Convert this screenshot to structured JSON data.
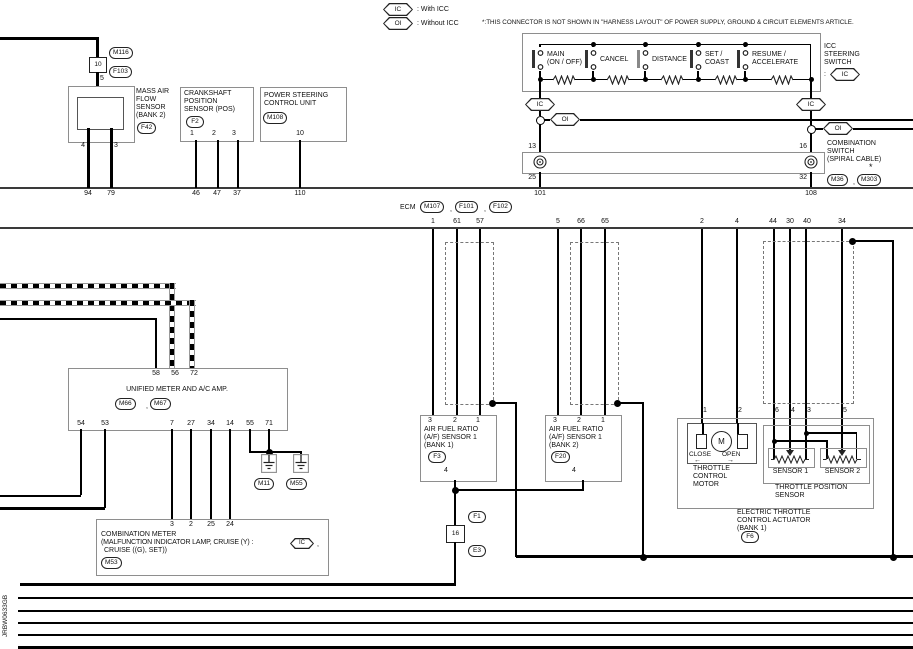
{
  "legend": {
    "ic": "IC",
    "ic_desc": ": With ICC",
    "oi": "OI",
    "oi_desc": ": Without ICC",
    "note": "*:THIS CONNECTOR IS NOT SHOWN IN \"HARNESS LAYOUT\" OF POWER SUPPLY, GROUND & CIRCUIT ELEMENTS ARTICLE."
  },
  "ic_oi": {
    "ic": "IC",
    "oi": "OI"
  },
  "icc_switch": {
    "switches": [
      {
        "l1": "MAIN",
        "l2": "(ON / OFF)"
      },
      {
        "l1": "CANCEL",
        "l2": ""
      },
      {
        "l1": "DISTANCE",
        "l2": ""
      },
      {
        "l1": "SET /",
        "l2": "COAST"
      },
      {
        "l1": "RESUME /",
        "l2": "ACCELERATE"
      }
    ],
    "label_l1": "ICC",
    "label_l2": "STEERING",
    "label_l3": "SWITCH",
    "label_sep": ":",
    "ic_tag": "IC"
  },
  "spiral": {
    "pin_tl": "13",
    "pin_tr": "16",
    "pin_bl": "25",
    "pin_br": "32",
    "label_l1": "COMBINATION",
    "label_l2": "SWITCH",
    "label_l3": "(SPIRAL CABLE)",
    "star": "*",
    "conn1": "M36",
    "comma": ",",
    "conn2": "M303"
  },
  "ecm": {
    "name": "ECM",
    "conn1": "M107",
    "conn2": "F101",
    "conn3": "F102",
    "comma": ",",
    "top_pins": [
      "94",
      "79",
      "46",
      "47",
      "37",
      "110",
      "101",
      "108"
    ],
    "bottom_pins": [
      "1",
      "61",
      "57",
      "5",
      "66",
      "65",
      "2",
      "4",
      "44",
      "30",
      "40",
      "34"
    ]
  },
  "maf": {
    "conn_box": "10",
    "conn_top": "M116",
    "conn_bot": "F103",
    "pin_top": "5",
    "l1": "MASS AIR",
    "l2": "FLOW",
    "l3": "SENSOR",
    "l4": "(BANK 2)",
    "conn": "F42",
    "pin_l": "4",
    "pin_r": "3"
  },
  "ckp": {
    "l1": "CRANKSHAFT",
    "l2": "POSITION",
    "l3": "SENSOR (POS)",
    "conn": "F2",
    "pins": [
      "1",
      "2",
      "3"
    ]
  },
  "ps": {
    "l1": "POWER STEERING",
    "l2": "CONTROL UNIT",
    "conn": "M108",
    "pin": "10"
  },
  "meter_amp": {
    "top_pins": [
      "58",
      "56",
      "72"
    ],
    "title": "UNIFIED METER AND A/C AMP.",
    "conn1": "M66",
    "comma": ",",
    "conn2": "M67",
    "bottom_pins": [
      "54",
      "53",
      "7",
      "27",
      "34",
      "14",
      "55",
      "71"
    ]
  },
  "grounds": {
    "g1": "M11",
    "g2": "M55"
  },
  "comb_meter": {
    "pins": [
      "3",
      "2",
      "25",
      "24"
    ],
    "l1": "COMBINATION METER",
    "l2a": "(MALFUNCTION INDICATOR LAMP, CRUISE (Y) :",
    "ic_tag": "IC",
    "l2b": ",",
    "l3": "CRUISE ((G), SET))",
    "conn": "M53"
  },
  "af1": {
    "pins": [
      "3",
      "2",
      "1"
    ],
    "l1": "AIR FUEL RATIO",
    "l2": "(A/F) SENSOR 1",
    "l3": "(BANK 1)",
    "conn": "F3",
    "pin_b": "4"
  },
  "af2": {
    "pins": [
      "3",
      "2",
      "1"
    ],
    "l1": "AIR FUEL RATIO",
    "l2": "(A/F) SENSOR 1",
    "l3": "(BANK 2)",
    "conn": "F20",
    "pin_b": "4"
  },
  "joint16": {
    "box": "16",
    "conn_top": "F1",
    "conn_bot": "E3"
  },
  "throttle": {
    "motor_pins": [
      "1",
      "2"
    ],
    "tps_pins": [
      "6",
      "4",
      "3",
      "5"
    ],
    "close": "CLOSE",
    "open": "OPEN",
    "arrow_l": "←",
    "arrow_r": "→",
    "m": "M",
    "motor_l1": "THROTTLE",
    "motor_l2": "CONTROL",
    "motor_l3": "MOTOR",
    "s1": "SENSOR 1",
    "s2": "SENSOR 2",
    "tps_l1": "THROTTLE POSITION",
    "tps_l2": "SENSOR",
    "l1": "ELECTRIC THROTTLE",
    "l2": "CONTROL ACTUATOR",
    "l3": "(BANK 1)",
    "conn": "F6"
  },
  "footer": {
    "code": "JRBW0633GB"
  }
}
